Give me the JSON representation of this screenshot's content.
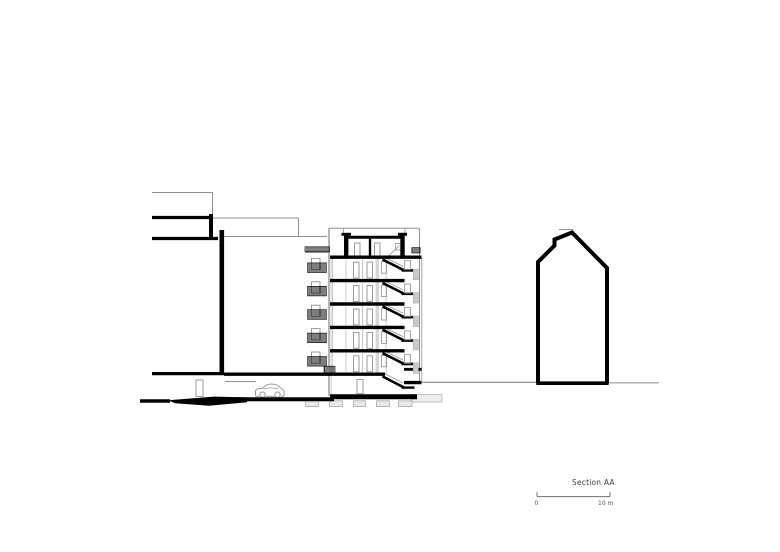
{
  "canvas": {
    "width": 780,
    "height": 552,
    "background": "#ffffff"
  },
  "title": {
    "label": "Section AA"
  },
  "scalebar": {
    "zero_label": "0",
    "max_label": "10 m",
    "x1": 537,
    "x2": 610,
    "y": 496.6,
    "tick_up": 4.3,
    "color": "#6f6f6f"
  },
  "palette": {
    "k": "#000000",
    "g": "#8f8f8f",
    "thin_light": "#b0b0b0",
    "slit_fill": "#c9c9c9",
    "band_light": "#e3e3e3",
    "band_mid": "#d6d6d6",
    "footing_fill": "#e8e8e8",
    "car": "#8a8a8a",
    "ground": "#9a9a9a",
    "text": "#3f3f3f"
  },
  "drawing": {
    "building": {
      "x_left": 330,
      "x_right": 421.5,
      "top_y": 228.3,
      "slab_ys": [
        257.2,
        280.6,
        304.0,
        327.4,
        350.8,
        374.2
      ],
      "slab_right_typ": 404.5,
      "slab_right_roof": 421.5,
      "ground_slab_x1": 224,
      "ground_slab_x2": 385,
      "base": {
        "x1": 330,
        "x2": 417,
        "y": 396.8,
        "w": 5
      },
      "stair": {
        "x1": 382.5,
        "x2": 403.8,
        "land_x2": 414.5
      },
      "balcony": {
        "door_x": 311.5,
        "door_w": 8.5,
        "door_h": 11.2,
        "rail_x": 307.5,
        "rail_w": 19,
        "rail_h": 9.6
      },
      "slit_x": 413.2,
      "bands": [
        {
          "n": "wall-band-left",
          "p": [
            330.2,
            258.9,
            2.2,
            137.0
          ],
          "fc": "#e3e3e3"
        },
        {
          "n": "wall-band-corridor",
          "p": [
            375.6,
            258.9,
            3.4,
            115.3
          ],
          "fc": "#d6d6d6"
        },
        {
          "n": "wall-band-stairwell",
          "p": [
            385.3,
            258.9,
            1.8,
            116.0
          ],
          "fc": "#e0e0e0"
        }
      ]
    },
    "elements": [
      {
        "n": "foundation-block-right",
        "t": "rect",
        "p": [
          411.5,
          394.6,
          30.5,
          7.4
        ],
        "sw": 0.8,
        "sc": "#b4b4b4",
        "fc": "#ededed"
      },
      {
        "n": "footing",
        "t": "rect",
        "p": [
          305.5,
          400.8,
          13,
          5.8
        ],
        "sw": 0.8,
        "sc": "#aaaaaa",
        "fc": "#e8e8e8"
      },
      {
        "n": "footing",
        "t": "rect",
        "p": [
          329.5,
          400.8,
          13,
          5.8
        ],
        "sw": 0.8,
        "sc": "#aaaaaa",
        "fc": "#e8e8e8"
      },
      {
        "n": "footing",
        "t": "rect",
        "p": [
          353.5,
          400.8,
          12,
          5.8
        ],
        "sw": 0.8,
        "sc": "#aaaaaa",
        "fc": "#e8e8e8"
      },
      {
        "n": "footing",
        "t": "rect",
        "p": [
          376.5,
          400.8,
          13,
          5.8
        ],
        "sw": 0.8,
        "sc": "#aaaaaa",
        "fc": "#e8e8e8"
      },
      {
        "n": "footing",
        "t": "rect",
        "p": [
          398.5,
          400.8,
          13.5,
          5.8
        ],
        "sw": 0.8,
        "sc": "#aaaaaa",
        "fc": "#e8e8e8"
      },
      {
        "n": "bg-roofline-left",
        "t": "line",
        "p": [
          152,
          192.5,
          213,
          192.5
        ],
        "w": 1,
        "c": "g"
      },
      {
        "n": "bg-roofline-left-v",
        "t": "line",
        "p": [
          212.5,
          192.5,
          212.5,
          216
        ],
        "w": 1,
        "c": "g"
      },
      {
        "n": "bg-outline-top",
        "t": "line",
        "p": [
          213,
          218,
          298.5,
          218
        ],
        "w": 1,
        "c": "g"
      },
      {
        "n": "bg-outline-right",
        "t": "line",
        "p": [
          298.5,
          218,
          298.5,
          236.5
        ],
        "w": 1,
        "c": "g"
      },
      {
        "n": "bg-outline-bottom",
        "t": "line",
        "p": [
          222,
          236.5,
          327,
          236.5
        ],
        "w": 1,
        "c": "g"
      },
      {
        "n": "garage-beam-line",
        "t": "line",
        "p": [
          225,
          381.5,
          256,
          381.5
        ],
        "w": 0.9,
        "c": "g"
      },
      {
        "n": "garage-door-frame",
        "t": "rect",
        "p": [
          196,
          380,
          7,
          16.5
        ],
        "sw": 0.9,
        "sc": "g",
        "fc": "none"
      },
      {
        "n": "ground-line-mid",
        "t": "line",
        "p": [
          421.5,
          382.3,
          536.5,
          382.3
        ],
        "w": 1.4,
        "c": "#9a9a9a"
      },
      {
        "n": "ground-line-right",
        "t": "line",
        "p": [
          608.5,
          382.8,
          659,
          382.8
        ],
        "w": 1.2,
        "c": "#9a9a9a"
      },
      {
        "n": "bg-peak-line",
        "t": "line",
        "p": [
          559,
          229.5,
          573,
          229.5
        ],
        "w": 1,
        "c": "g"
      },
      {
        "n": "building-outline-top",
        "t": "line",
        "p": [
          329,
          228.3,
          419.5,
          228.3
        ],
        "w": 1,
        "c": "g"
      },
      {
        "n": "building-left-wall",
        "t": "line",
        "p": [
          329,
          228.3,
          329,
          396
        ],
        "w": 1.1,
        "c": "#787878"
      },
      {
        "n": "building-left-inner",
        "t": "line",
        "p": [
          332.6,
          259,
          332.6,
          374
        ],
        "w": 0.7,
        "c": "#bbbbbb"
      },
      {
        "n": "building-right-wall",
        "t": "line",
        "p": [
          419.5,
          228.3,
          419.5,
          381
        ],
        "w": 1,
        "c": "g"
      },
      {
        "n": "building-right-wall-2",
        "t": "line",
        "p": [
          421.8,
          258,
          421.8,
          381
        ],
        "w": 0.8,
        "c": "g"
      },
      {
        "n": "roof-rail-post-l",
        "t": "line",
        "p": [
          343.5,
          228.3,
          343.5,
          234.3
        ],
        "w": 0.8,
        "c": "g"
      },
      {
        "n": "roof-rail-post-r",
        "t": "line",
        "p": [
          405,
          228.3,
          405,
          234.3
        ],
        "w": 0.8,
        "c": "g"
      },
      {
        "n": "terrace-edge-line",
        "t": "line",
        "p": [
          305,
          252.5,
          330,
          252.5
        ],
        "w": 0.9,
        "c": "g"
      },
      {
        "n": "penthouse-stair-outline",
        "t": "line",
        "p": [
          388,
          256.5,
          399.5,
          245.5
        ],
        "w": 0.8,
        "c": "g"
      },
      {
        "n": "penthouse-stair-newel",
        "t": "rect",
        "p": [
          395.5,
          243.5,
          6.5,
          6.5
        ],
        "sw": 0.8,
        "sc": "g",
        "fc": "none"
      },
      {
        "n": "penthouse-door-frame",
        "t": "rect",
        "p": [
          354.5,
          243,
          5.5,
          13
        ],
        "sw": 0.9,
        "sc": "g",
        "fc": "none"
      },
      {
        "n": "penthouse-door-frame",
        "t": "rect",
        "p": [
          374.5,
          243,
          5.5,
          13
        ],
        "sw": 0.9,
        "sc": "g",
        "fc": "none"
      },
      {
        "n": "basement-door-frame",
        "t": "rect",
        "p": [
          357,
          379.5,
          6,
          14.2
        ],
        "sw": 0.9,
        "sc": "g",
        "fc": "none"
      },
      {
        "n": "car-body",
        "t": "path",
        "d": "M255.8,396.3 L255.4,391.8 Q255.4,389.3 258.2,388.7 L262.5,388.3 Q265.8,384.6 270.2,384.1 Q275.4,383.6 278.6,386.2 L281.2,388.5 Q283.6,389.1 284.1,391.6 L284.0,396.0 L280.6,396.3 M274.4,396.3 L265.6,396.3 M259.4,396.3 L255.8,396.3",
        "w": 0.9,
        "c": "#8a8a8a"
      },
      {
        "n": "car-beltline",
        "t": "path",
        "d": "M263.5,388.8 Q270,387.2 278,388.6",
        "w": 0.7,
        "c": "#8a8a8a"
      },
      {
        "n": "car-wheel",
        "t": "circle",
        "p": [
          262.5,
          394.6,
          2.7
        ],
        "w": 0.9,
        "c": "#8a8a8a"
      },
      {
        "n": "car-wheel",
        "t": "circle",
        "p": [
          277.5,
          394.6,
          2.7
        ],
        "w": 0.9,
        "c": "#8a8a8a"
      },
      {
        "n": "roof-railing-hatch-left",
        "t": "hatch",
        "p": [
          305,
          246.8,
          24.5,
          4.8
        ]
      },
      {
        "n": "roof-railing-hatch-right",
        "t": "hatch",
        "p": [
          411.8,
          247.6,
          8.4,
          5.4
        ]
      },
      {
        "n": "ground-vent-grille",
        "t": "hatch",
        "p": [
          324,
          366.2,
          11,
          7.6
        ]
      },
      {
        "n": "neighbor-roof-bar-upper",
        "t": "line",
        "p": [
          152,
          217.5,
          212,
          217.5
        ],
        "w": 3.2,
        "c": "k"
      },
      {
        "n": "neighbor-wall-stub",
        "t": "line",
        "p": [
          211,
          214,
          211,
          240
        ],
        "w": 4,
        "c": "k"
      },
      {
        "n": "neighbor-roof-bar-lower",
        "t": "line",
        "p": [
          152,
          238.5,
          218,
          238.5
        ],
        "w": 3.2,
        "c": "k"
      },
      {
        "n": "neighbor-party-wall",
        "t": "line",
        "p": [
          221.8,
          230,
          221.8,
          374.5
        ],
        "w": 4.6,
        "c": "k"
      },
      {
        "n": "neighbor-ground-slab",
        "t": "line",
        "p": [
          152,
          373.6,
          224,
          373.6
        ],
        "w": 3.2,
        "c": "k"
      },
      {
        "n": "street-level-left",
        "t": "line",
        "p": [
          140,
          401,
          170,
          401
        ],
        "w": 3.4,
        "c": "k"
      },
      {
        "n": "garage-ramp-wedge",
        "t": "poly",
        "pts": [
          [
            168,
            400.3
          ],
          [
            214,
            396.6
          ],
          [
            247,
            397.4
          ],
          [
            247,
            402.2
          ],
          [
            209,
            405.8
          ],
          [
            175,
            403.2
          ]
        ],
        "fc": "#000000"
      },
      {
        "n": "garage-floor-slab",
        "t": "line",
        "p": [
          235,
          399.3,
          334,
          399.3
        ],
        "w": 4,
        "c": "k"
      },
      {
        "n": "building-base-slab",
        "t": "line",
        "p": [
          330,
          396.8,
          417,
          396.8
        ],
        "w": 5,
        "c": "k"
      },
      {
        "n": "entrance-canopy",
        "t": "line",
        "p": [
          404,
          369.3,
          421.5,
          369.3
        ],
        "w": 2.8,
        "c": "k"
      },
      {
        "n": "entrance-slab",
        "t": "line",
        "p": [
          404,
          382.6,
          421.5,
          382.6
        ],
        "w": 3.4,
        "c": "k"
      },
      {
        "n": "penthouse-cap-left",
        "t": "line",
        "p": [
          341.5,
          234.3,
          351,
          234.3
        ],
        "w": 3,
        "c": "k"
      },
      {
        "n": "penthouse-cap-right",
        "t": "line",
        "p": [
          398,
          234.3,
          407,
          234.3
        ],
        "w": 3,
        "c": "k"
      },
      {
        "n": "penthouse-parapet-left",
        "t": "line",
        "p": [
          346.2,
          235,
          346.2,
          257
        ],
        "w": 4.4,
        "c": "k"
      },
      {
        "n": "penthouse-parapet-right",
        "t": "line",
        "p": [
          402.5,
          235,
          402.5,
          257
        ],
        "w": 4.4,
        "c": "k"
      },
      {
        "n": "penthouse-roof-slab",
        "t": "line",
        "p": [
          348,
          237.2,
          400.5,
          237.2
        ],
        "w": 3,
        "c": "k"
      },
      {
        "n": "penthouse-interior-wall",
        "t": "line",
        "p": [
          370,
          238.8,
          370,
          255.8
        ],
        "w": 2.4,
        "c": "k"
      },
      {
        "n": "basement-stair-outline",
        "t": "line",
        "p": [
          383.5,
          373.2,
          403,
          382.8
        ],
        "w": 0.8,
        "c": "g"
      },
      {
        "n": "basement-stair-flight",
        "t": "line",
        "p": [
          382.5,
          376.4,
          403.8,
          387.4
        ],
        "w": 2.6,
        "c": "k"
      },
      {
        "n": "basement-stair-landing",
        "t": "line",
        "p": [
          401.5,
          387.6,
          414.5,
          387.6
        ],
        "w": 2.4,
        "c": "k"
      },
      {
        "n": "right-building-outline",
        "t": "pline",
        "pts": [
          [
            538,
            383.3
          ],
          [
            538,
            262
          ],
          [
            554.5,
            245.5
          ],
          [
            554.5,
            239.5
          ],
          [
            572,
            232.5
          ],
          [
            607,
            268
          ],
          [
            607,
            383.3
          ]
        ],
        "w": 4,
        "c": "k"
      },
      {
        "n": "right-building-base",
        "t": "line",
        "p": [
          536.3,
          383.2,
          608.7,
          383.2
        ],
        "w": 3.6,
        "c": "k"
      }
    ]
  },
  "labels": {
    "title_pos": {
      "left": 572,
      "top": 479
    },
    "zero_pos": {
      "left": 534.5,
      "top": 500.5
    },
    "max_pos": {
      "left": 598,
      "top": 500.5
    }
  }
}
